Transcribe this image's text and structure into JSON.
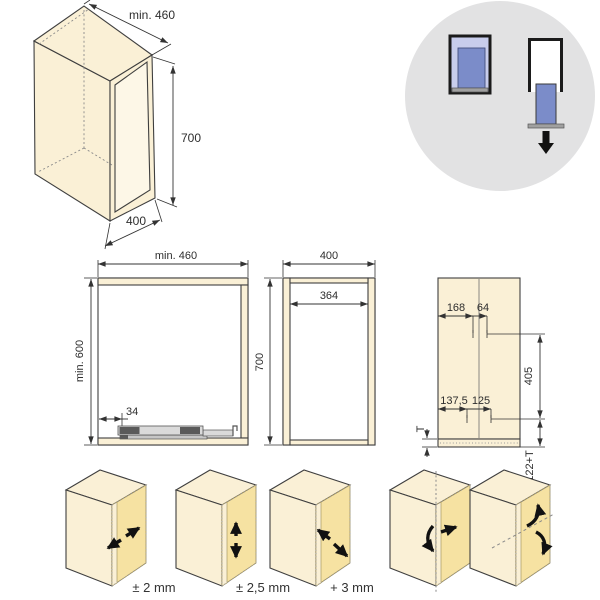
{
  "figure": {
    "title": "cabinet-installation-diagram",
    "colors": {
      "panel_cream": "#FAF0D6",
      "panel_front_yellow": "#F6E2A2",
      "badge_circle_gray": "#E2E2E3",
      "drawer_blue": "#7B8CC9",
      "drawer_light_blue": "#C8CDEC",
      "base_gray": "#A0A0A0",
      "line": "#3F3F3F"
    }
  },
  "iso_cabinet": {
    "depth_label": "min. 460",
    "height_label": "700",
    "width_label": "400"
  },
  "orientation_badge": {
    "icons": [
      "drawer-inserted-icon",
      "drawer-slide-out-icon",
      "down-arrow-icon"
    ]
  },
  "front_view": {
    "width_label": "min. 460",
    "height_label": "min. 600",
    "slide_offset_label": "34"
  },
  "side_view": {
    "width_label": "400",
    "inner_width_label": "364",
    "height_label": "700"
  },
  "drilling_view": {
    "top_dim_1": "168",
    "top_dim_2": "64",
    "right_dim": "405",
    "bottom_dim_1": "137,5",
    "bottom_dim_2": "125",
    "thickness_dim": "T",
    "bottom_right_dim": "122+T"
  },
  "adjustments": {
    "labels": [
      "± 2 mm",
      "± 2,5 mm",
      "+ 3 mm"
    ]
  }
}
